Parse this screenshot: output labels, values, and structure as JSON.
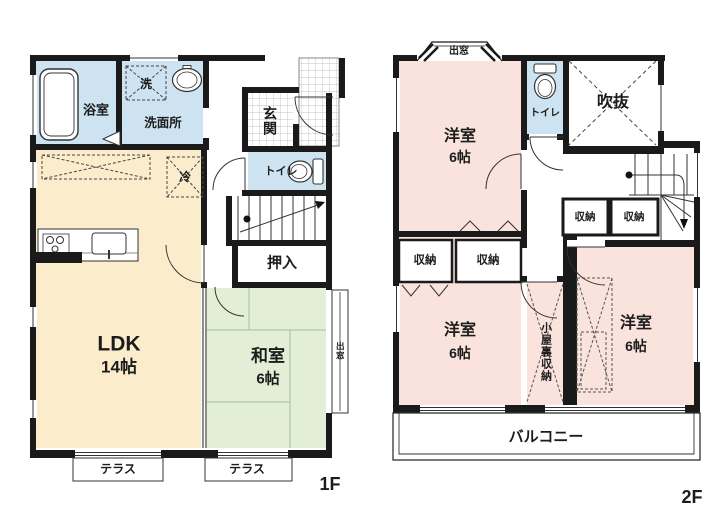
{
  "colors": {
    "wall": "#1a1a1a",
    "water_blue": "#cde3f1",
    "ldk_cream": "#fbeccb",
    "tatami_green": "#e3eed7",
    "bedroom_pink": "#f9e3dc"
  },
  "floor1": {
    "floor_label": "1F",
    "bath": "浴室",
    "laundry": "洗",
    "washroom": "洗面所",
    "entrance": "玄関",
    "toilet": "トイレ",
    "fridge": "冷",
    "closet": "押入",
    "ldk": "LDK",
    "ldk_size": "14帖",
    "washitsu": "和室",
    "washitsu_size": "6帖",
    "bay_window": "出窓",
    "terrace_left": "テラス",
    "terrace_right": "テラス"
  },
  "floor2": {
    "floor_label": "2F",
    "bay_window": "出窓",
    "bedroom_nw": "洋室",
    "bedroom_nw_size": "6帖",
    "toilet": "トイレ",
    "void": "吹抜",
    "storage_mid_left": "収納",
    "storage_mid_right": "収納",
    "storage_sw_left": "収納",
    "storage_sw_right": "収納",
    "bedroom_sw": "洋室",
    "bedroom_sw_size": "6帖",
    "attic_storage": "小屋裏収納",
    "bedroom_se": "洋室",
    "bedroom_se_size": "6帖",
    "balcony": "バルコニー"
  }
}
